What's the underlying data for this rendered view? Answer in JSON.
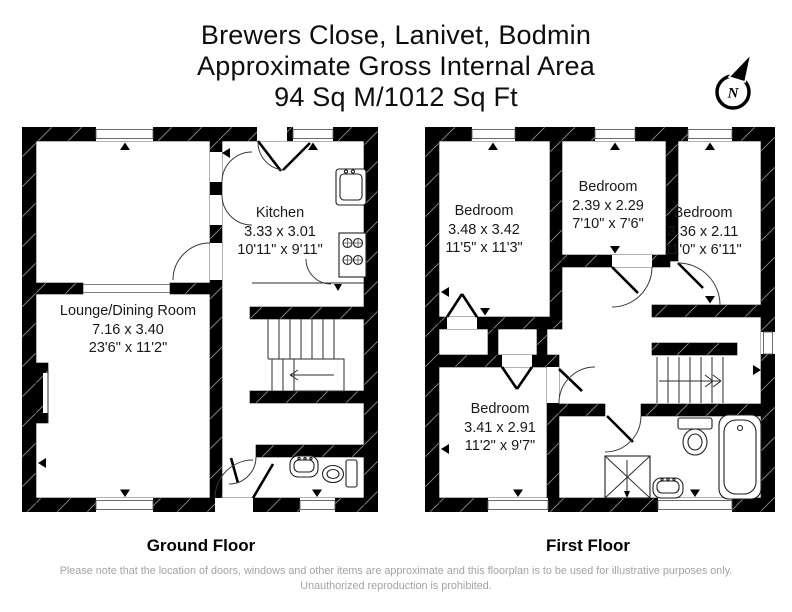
{
  "header": {
    "address": "Brewers Close, Lanivet, Bodmin",
    "area_label": "Approximate Gross Internal Area",
    "area_value": "94 Sq M/1012 Sq Ft"
  },
  "compass": {
    "north_label": "N"
  },
  "floors": {
    "ground": {
      "caption": "Ground Floor",
      "rooms": {
        "kitchen": {
          "name": "Kitchen",
          "metric": "3.33 x 3.01",
          "imperial": "10'11\" x 9'11\""
        },
        "lounge": {
          "name": "Lounge/Dining Room",
          "metric": "7.16 x 3.40",
          "imperial": "23'6\" x 11'2\""
        }
      }
    },
    "first": {
      "caption": "First Floor",
      "rooms": {
        "bedroom1": {
          "name": "Bedroom",
          "metric": "3.48 x 3.42",
          "imperial": "11'5\" x 11'3\""
        },
        "bedroom2": {
          "name": "Bedroom",
          "metric": "2.39 x 2.29",
          "imperial": "7'10\" x 7'6\""
        },
        "bedroom3": {
          "name": "Bedroom",
          "metric": "3.36 x 2.11",
          "imperial": "11'0\" x 6'11\""
        },
        "bedroom4": {
          "name": "Bedroom",
          "metric": "3.41 x 2.91",
          "imperial": "11'2\" x 9'7\""
        }
      }
    }
  },
  "icons": {
    "compass": "north-compass-icon",
    "ground_fixtures": [
      "kitchen-sink-icon",
      "hob-icon",
      "wc-basin-icon",
      "wc-toilet-icon",
      "staircase-icon"
    ],
    "first_fixtures": [
      "toilet-icon",
      "bath-icon",
      "shower-icon",
      "basin-icon",
      "staircase-icon"
    ]
  },
  "footer": {
    "disclaimer": "Please note that the location of doors, windows and other items are approximate and this floorplan is to be used for illustrative purposes only. Unauthorized reproduction is prohibited."
  }
}
